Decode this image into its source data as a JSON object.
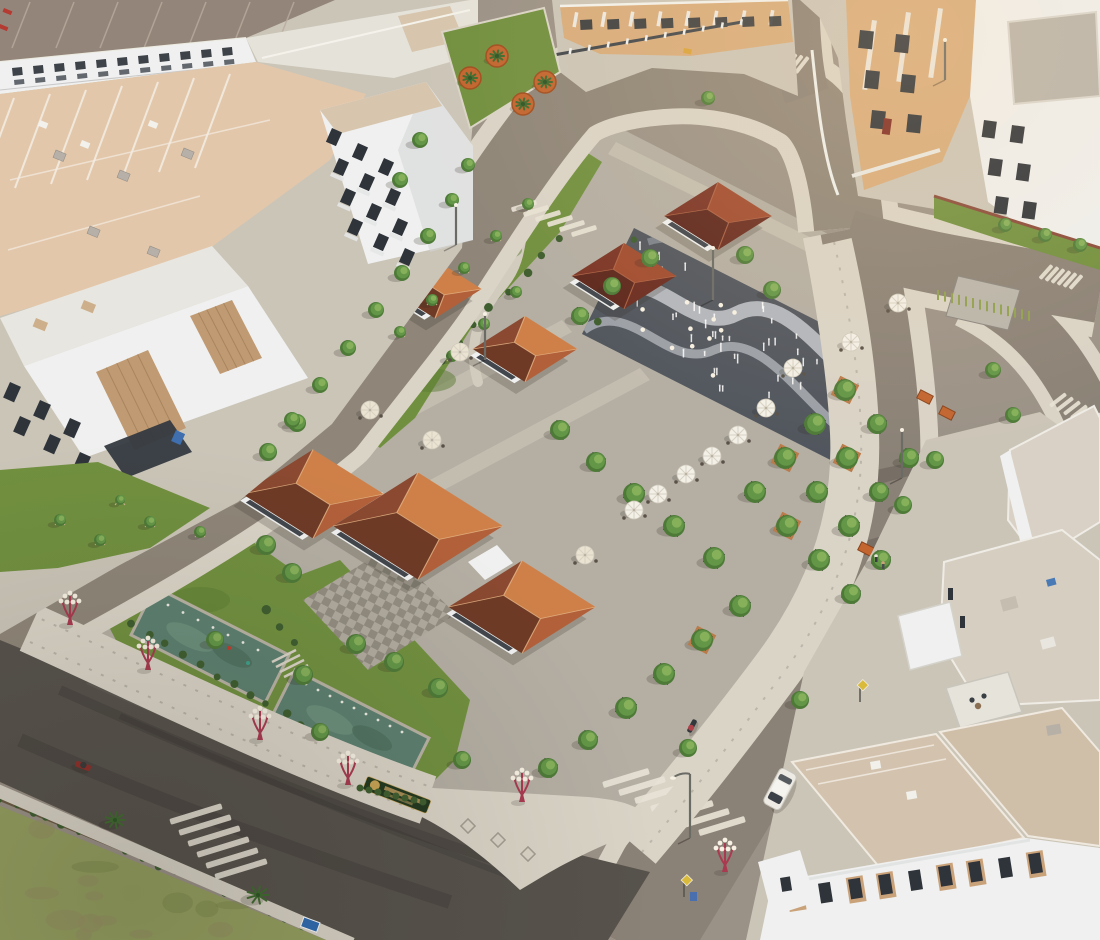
{
  "meta": {
    "caption": "Aerial golden-hour photograph of a new residential development: a central landscaped plaza with hip-roofed pavilions, gazebos, a dry fountain with water jets, reflecting pools, tree-lined promenades with red ornamental lamps, surrounded by white-and-tan townhouse rows, roads with zebra crossings, a parked car, motorbikes and a green field at lower left",
    "time_of_day": "late afternoon"
  },
  "palette": {
    "asphalt_light": "#9b9287",
    "asphalt_mid": "#8b8277",
    "asphalt_dark": "#57524c",
    "road_loop": "#8f8679",
    "sidewalk": "#dad4c7",
    "sidewalk_dim": "#cbc5b8",
    "paver_dot": "#a39d91",
    "plaza": "#b4aea3",
    "plaza_band": "#c6c0b3",
    "plaza_light": "#d2ccbf",
    "checker_a": "#b1ab9f",
    "checker_b": "#938d81",
    "lawn": "#71903f",
    "lawn_dark": "#5c7c34",
    "hedge": "#3f5e2f",
    "tree": "#639647",
    "tree_dark": "#4e7a38",
    "tree_light": "#8cb55e",
    "field": "#95a05f",
    "field_dark": "#7d8a4c",
    "field_brown": "#988f63",
    "pool": "#5d8070",
    "pool_dark": "#496a59",
    "pool_light": "#7ea28c",
    "fountain_dark": "#51565e",
    "fountain_band": "#b7bcc2",
    "roof_terra_top": "#cf8049",
    "roof_terra_rt": "#b2603a",
    "roof_terra_lt": "#8a4930",
    "roof_terra_bot": "#6e3a26",
    "roof_maroon_top": "#a14c30",
    "roof_maroon_bot": "#5e281e",
    "roof_maroon_side": "#7c3526",
    "roof_tan": "#d7c5ad",
    "roof_pink": "#e3c7aa",
    "roof_brown": "#93857a",
    "roof_white": "#e5e2da",
    "wall_white": "#eff0ef",
    "wall_shadow": "#d4d5d6",
    "wall_tan": "#d8ac7c",
    "wall_slat": "#c09a72",
    "window": "#2f343b",
    "lamp_red": "#a93a50",
    "lamp_globe": "#f7f1e3",
    "stripe": "#e7e2d5",
    "planter_wood": "#b97b4a",
    "planter_orange": "#c2652f",
    "planter_dark": "#30342c",
    "car": "#edebe4",
    "umbrella": "#f3f0e8",
    "umbrella_pale": "#eae3d2",
    "sign_green": "#23381f",
    "sign_gold": "#c9a455",
    "sign_blue": "#2f6cb3",
    "sign_yellow": "#d9ba3a",
    "shadow": "rgba(45,42,35,0.42)"
  },
  "scene": {
    "plaza": {
      "pavilion_roofs": 3,
      "garden_gazebos": 4,
      "patio_umbrellas": 13,
      "reflecting_pools": 2,
      "dry_fountain_jets": 40,
      "ornamental_red_lamps": 6
    },
    "roads": {
      "zebra_crossings": 7,
      "vehicles": {
        "cars": 1,
        "motorbikes": 2
      }
    },
    "landscape": {
      "street_trees_approx": 72,
      "palm_planters": 4,
      "project_sign": "illegible gold lettering on dark green board"
    }
  }
}
